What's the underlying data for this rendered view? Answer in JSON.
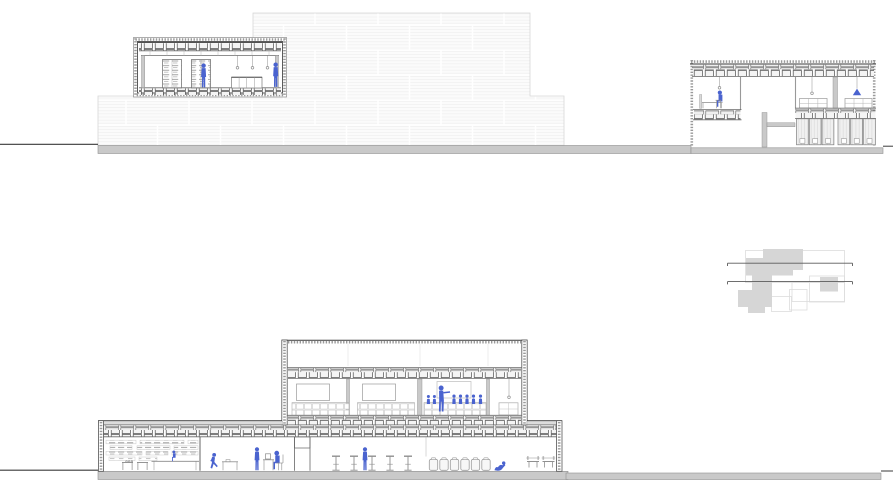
{
  "drawing": {
    "type": "architectural-sections",
    "colors": {
      "figure_blue": "#4a63cf",
      "line_dark": "#3a3a3a",
      "wall_gray": "#c9c9c9",
      "ground_gray": "#c9c9c9",
      "furniture_gray": "#8a8a8a",
      "plan_gray": "#d6d6d6",
      "paper_white": "#ffffff"
    },
    "sections": {
      "upper": {
        "reading_room": {
          "bookshelves": 2,
          "pendant_lights": 3,
          "cabinet_doors": 4,
          "figures": [
            "person-at-bookshelf",
            "person-standing"
          ]
        },
        "masonry_elevation": {
          "blocks_pattern": "running-bond"
        },
        "dormitory": {
          "beds": 2,
          "pendant_lights": 2,
          "blue_hanging_lamps": 1,
          "lockers": 6,
          "figures": [
            "person-seated-at-desk"
          ]
        }
      },
      "lower": {
        "upper_floor": {
          "lounge_rooms": 2,
          "screens": 3,
          "pendant_lights": 1,
          "figures": {
            "presenter": 1,
            "audience": 7
          }
        },
        "ground_floor": {
          "bar_stools": 5,
          "storage_jars": 6,
          "gym_benches": 2,
          "wall_shelf_rows": 4,
          "figures": [
            "person-sitting-on-counter",
            "person-running",
            "person-standing-at-desk",
            "person-seated-at-desk",
            "person-standing-at-bar",
            "person-floor-exercise"
          ]
        }
      },
      "key_plan": {
        "section_cut_lines": 2,
        "building_masses": 2
      }
    }
  }
}
